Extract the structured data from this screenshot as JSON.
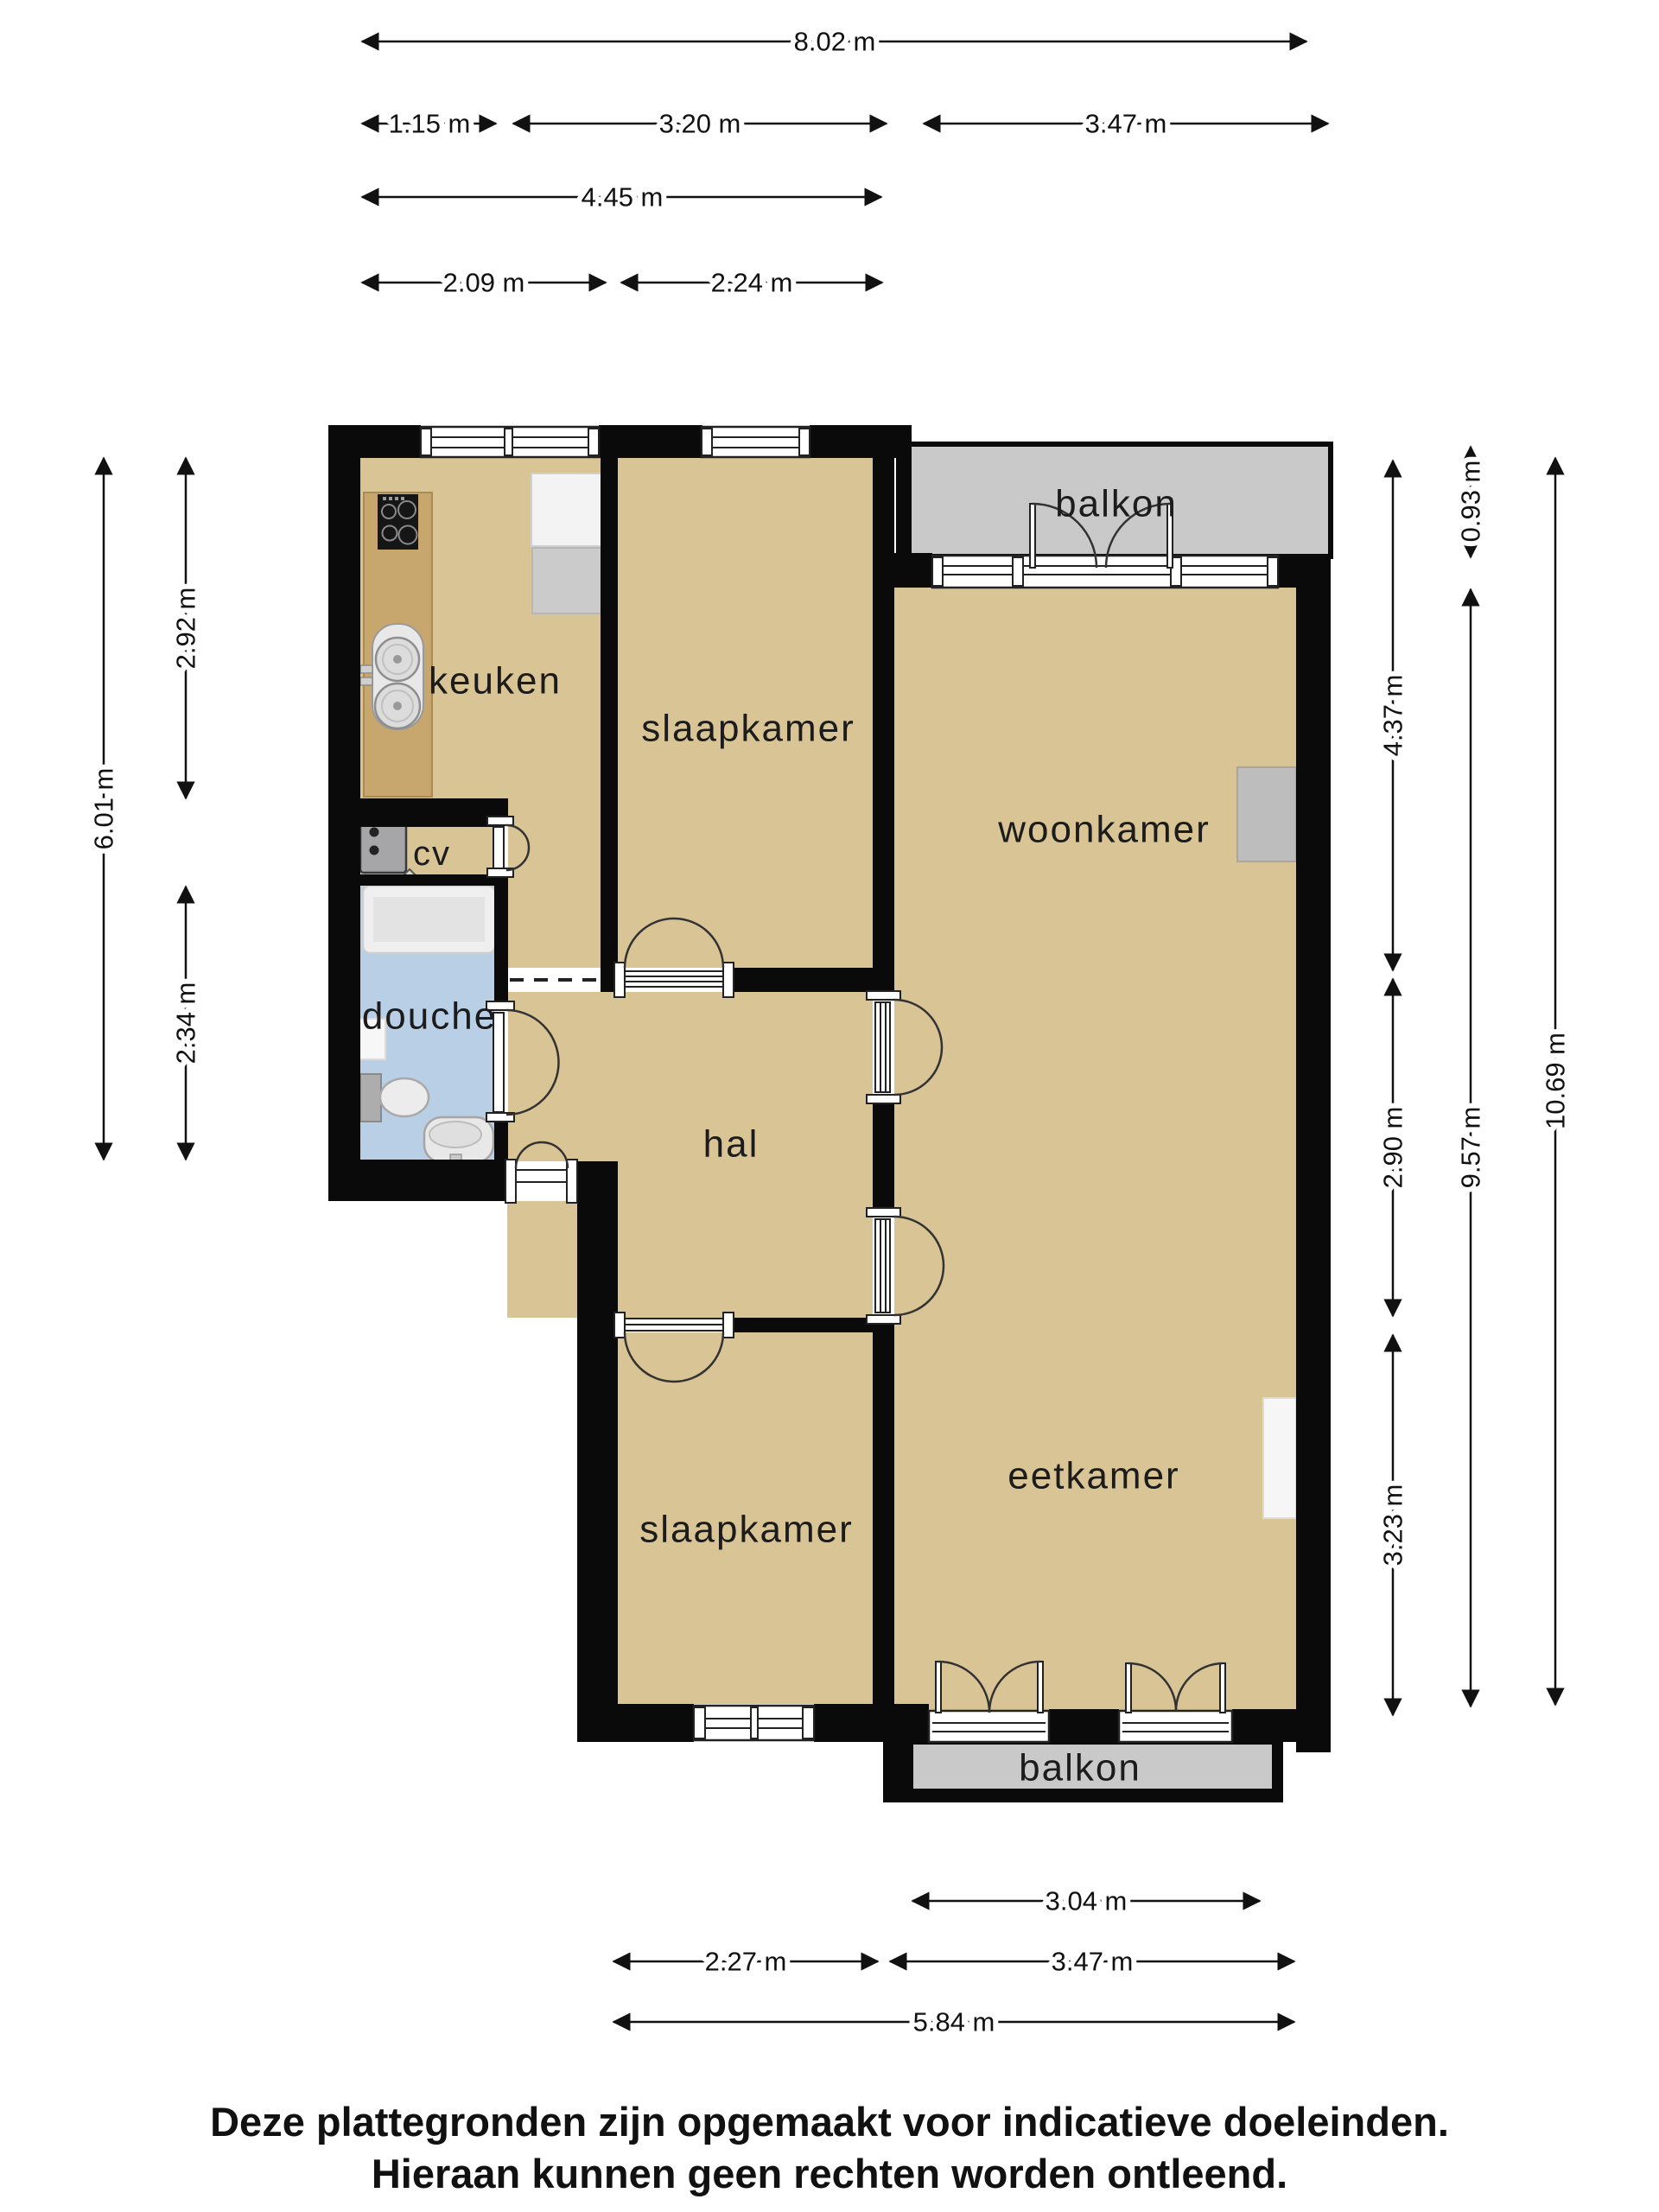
{
  "colors": {
    "floor": "#D8C495",
    "wall": "#0A0A0A",
    "balcony": "#C9C9C9",
    "bath": "#B9CFE6",
    "counter": "#C8A76F",
    "line": "#111111",
    "label": "#1C1C1C"
  },
  "rooms": {
    "kitchen": {
      "label": "keuken"
    },
    "bedroom1": {
      "label": "slaapkamer"
    },
    "bedroom2": {
      "label": "slaapkamer"
    },
    "living": {
      "label": "woonkamer"
    },
    "dining": {
      "label": "eetkamer"
    },
    "hall": {
      "label": "hal"
    },
    "shower": {
      "label": "douche"
    },
    "boiler_closet": {
      "label": "cv"
    },
    "balcony_top": {
      "label": "balkon"
    },
    "balcony_bottom": {
      "label": "balkon"
    }
  },
  "dimensions": {
    "top": [
      {
        "label": "8.02 m"
      },
      {
        "label": "1.15 m"
      },
      {
        "label": "3.20 m"
      },
      {
        "label": "3.47 m"
      },
      {
        "label": "4.45 m"
      },
      {
        "label": "2.09 m"
      },
      {
        "label": "2.24 m"
      }
    ],
    "left": [
      {
        "label": "6.01 m"
      },
      {
        "label": "2.92 m"
      },
      {
        "label": "2.34 m"
      }
    ],
    "right": [
      {
        "label": "0.93 m"
      },
      {
        "label": "4.37 m"
      },
      {
        "label": "2.90 m"
      },
      {
        "label": "3.23 m"
      },
      {
        "label": "9.57 m"
      },
      {
        "label": "10.69 m"
      }
    ],
    "bottom": [
      {
        "label": "3.04 m"
      },
      {
        "label": "2.27 m"
      },
      {
        "label": "3.47 m"
      },
      {
        "label": "5.84 m"
      }
    ]
  },
  "disclaimer": {
    "line1": "Deze plattegronden zijn opgemaakt voor indicatieve doeleinden.",
    "line2": "Hieraan kunnen geen rechten worden ontleend."
  }
}
